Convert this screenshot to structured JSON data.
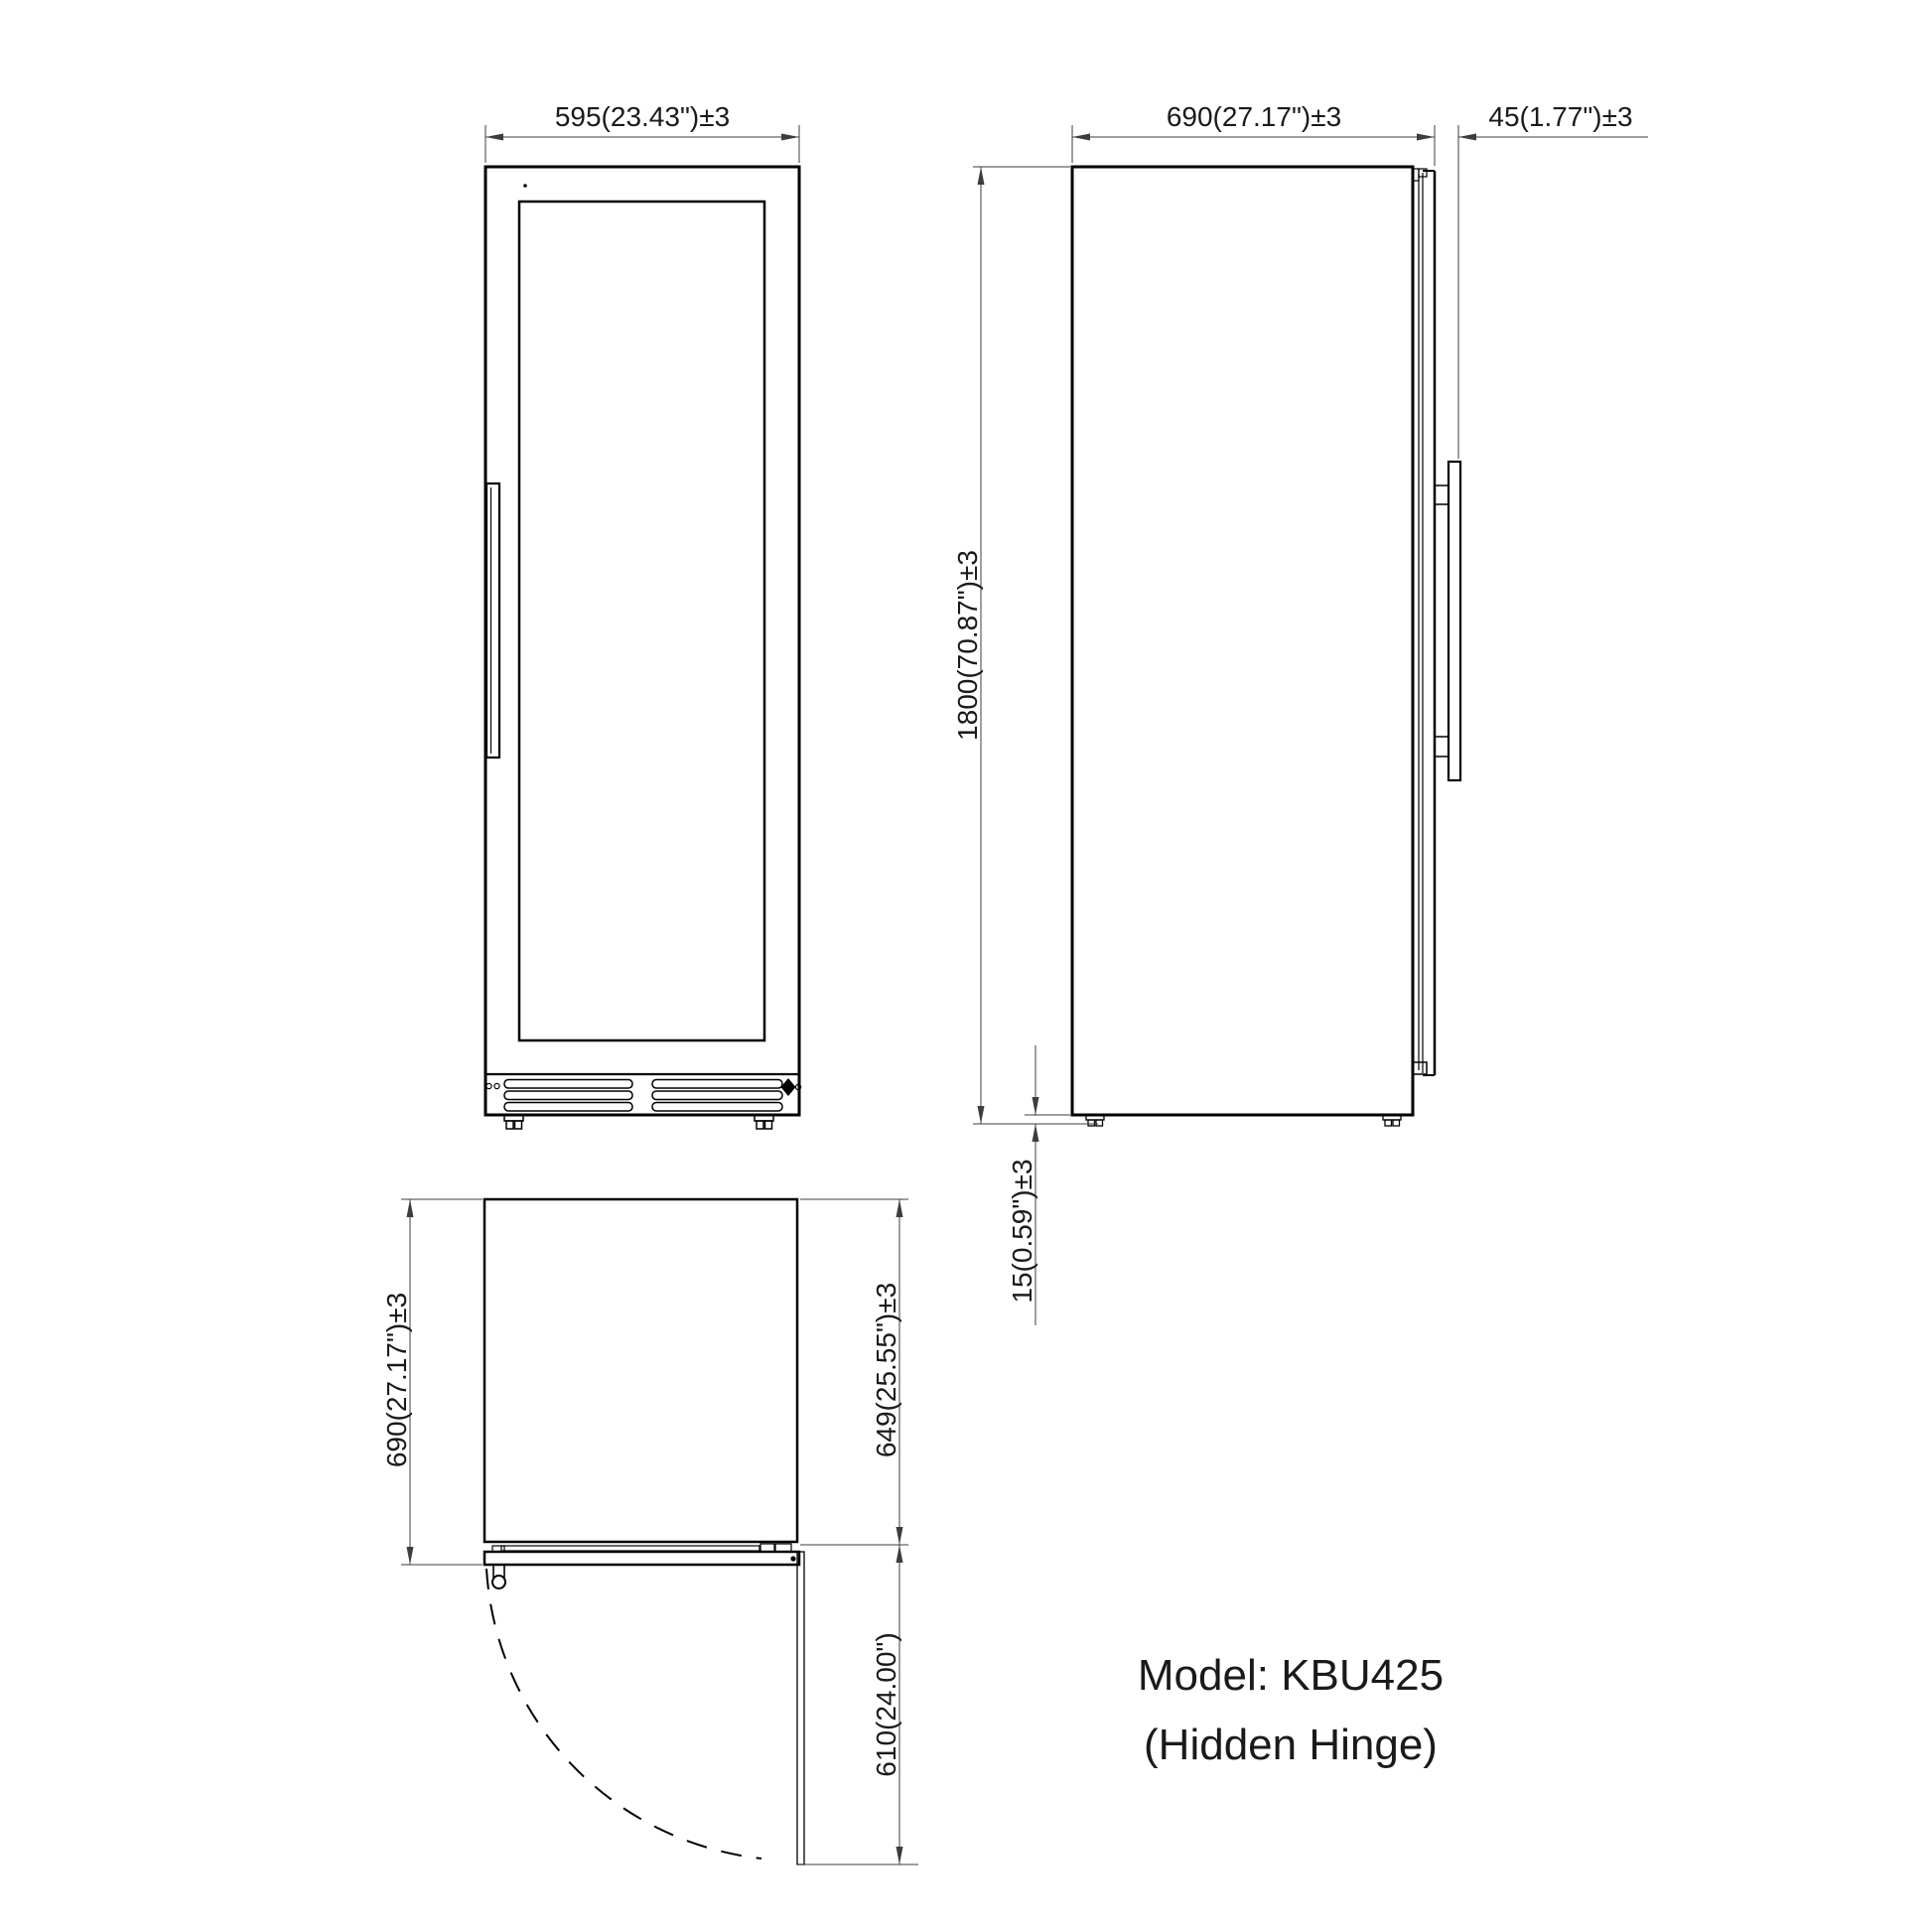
{
  "title": {
    "line1": "Model: KBU425",
    "line2": "(Hidden Hinge)"
  },
  "views": {
    "front": {
      "width_dim": "595(23.43\")±3"
    },
    "side": {
      "depth_dim": "690(27.17\")±3",
      "handle_dim": "45(1.77\")±3",
      "height_dim": "1800(70.87\")±3",
      "ground_clearance_dim": "15(0.59\")±3"
    },
    "top": {
      "overall_depth_dim": "690(27.17\")±3",
      "body_depth_dim": "649(25.55\")±3",
      "door_swing_dim": "610(24.00\")"
    }
  },
  "colors": {
    "background": "#ffffff",
    "object_line": "#000000",
    "dimension_line": "#3d3d3d",
    "text": "#1a1a1a"
  }
}
